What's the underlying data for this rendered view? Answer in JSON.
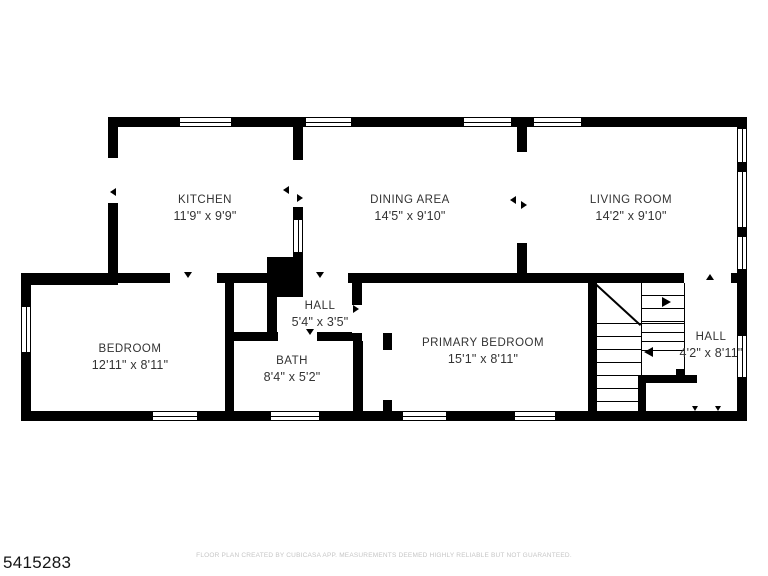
{
  "plan": {
    "id": "5415283",
    "disclaimer": "FLOOR PLAN CREATED BY CUBICASA APP. MEASUREMENTS DEEMED HIGHLY RELIABLE BUT NOT GUARANTEED."
  },
  "rooms": [
    {
      "name": "KITCHEN",
      "dims": "11'9\" x 9'9\""
    },
    {
      "name": "DINING AREA",
      "dims": "14'5\" x 9'10\""
    },
    {
      "name": "LIVING ROOM",
      "dims": "14'2\" x 9'10\""
    },
    {
      "name": "BEDROOM",
      "dims": "12'11\" x 8'11\""
    },
    {
      "name": "HALL",
      "dims": "5'4\" x 3'5\""
    },
    {
      "name": "BATH",
      "dims": "8'4\" x 5'2\""
    },
    {
      "name": "PRIMARY BEDROOM",
      "dims": "15'1\" x 8'11\""
    },
    {
      "name": "HALL",
      "dims": "4'2\" x 8'11\""
    }
  ]
}
